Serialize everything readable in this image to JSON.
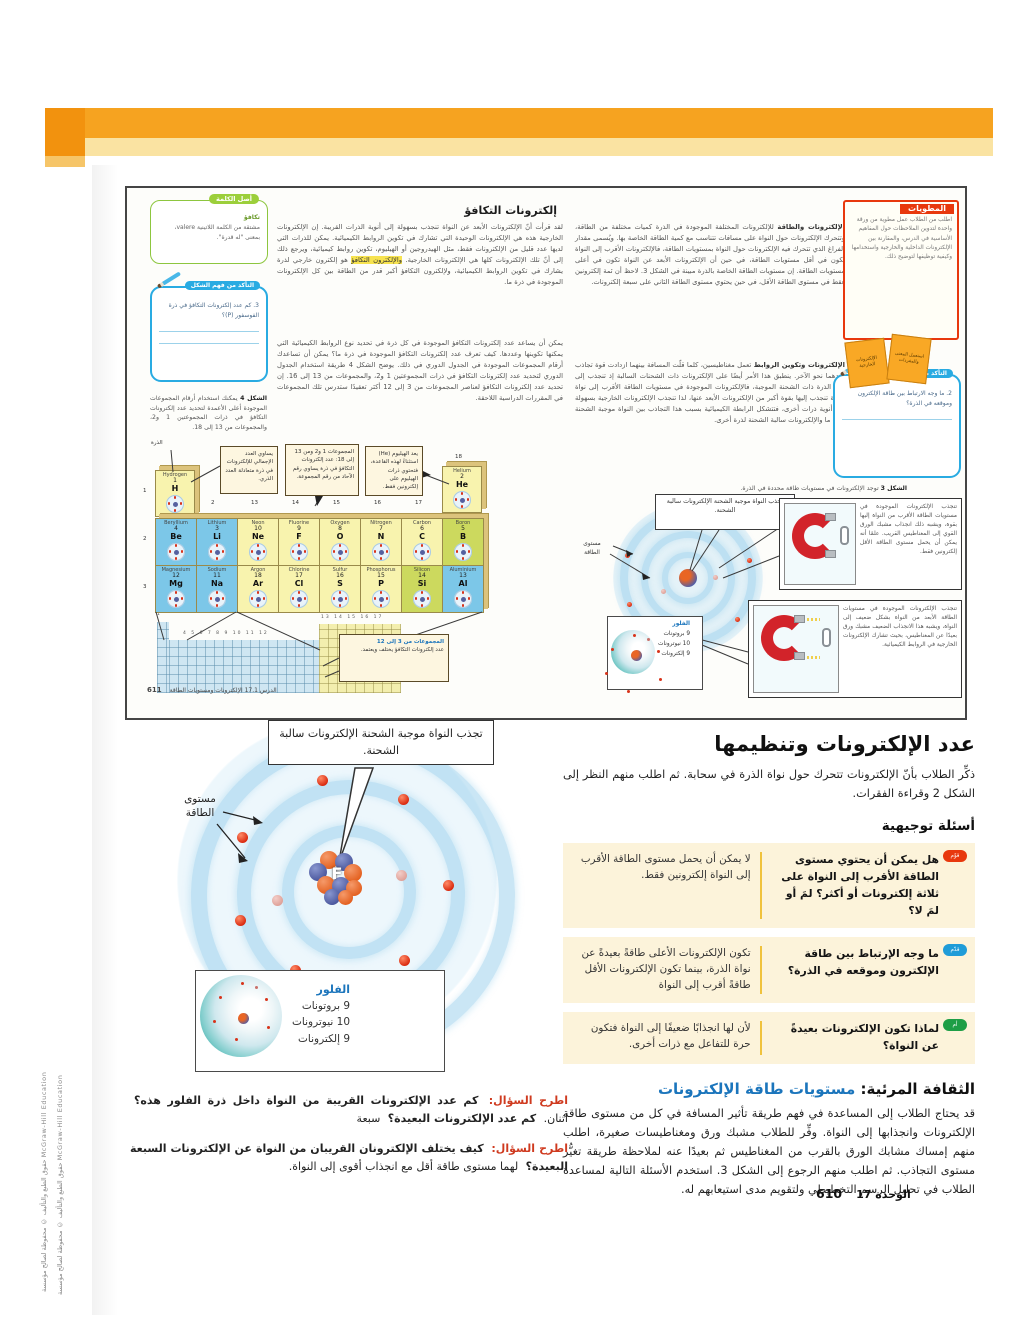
{
  "colors": {
    "accent_orange": "#f6a320",
    "band_pale": "#fae3a2",
    "badge_red": "#e8380d",
    "badge_blue": "#1f9cd8",
    "badge_green": "#1e9e46",
    "heading_blue": "#1b75bc",
    "box_cream": "#fcf3da"
  },
  "page": {
    "copyright": "حقوق الطبع والتأليف © محفوظة لصالح مؤسسة McGraw-Hill Education",
    "photo_credit": "McGraw-Hill Education",
    "footer_page": "610",
    "footer_unit": "الوحدة 17"
  },
  "mini": {
    "left": {
      "heading": "إلكترونات التكافؤ",
      "para1a": "لقد قرأت أنّ الإلكترونات الأبعد عن النواة تنجذب بسهولة إلى أنوية الذرات القريبة. إن الإلكترونات الخارجية هذه هي الإلكترونات الوحيدة التي تشارك في تكوين الروابط الكيميائية. يمكن للذرات التي لديها عدد قليل من الإلكترونات فقط، مثل الهيدروجين أو الهيليوم، تكوين روابط كيميائية، ويرجع ذلك إلى أنّ تلك الإلكترونات كلها هي الإلكترونات الخارجية.",
      "para1_highlight": "والإلكترون التكافؤ",
      "para1b": "هو إلكترون خارجي لذرة يشارك في تكوين الروابط الكيميائية، ولإلكترون التكافؤ أكبر قدر من الطاقة بين كل الإلكترونات الموجودة في ذرة ما.",
      "para2": "يمكن أن يساعد عدد إلكترونات التكافؤ الموجودة في كل ذرة في تحديد نوع الروابط الكيميائية التي يمكنها تكوينها وعددها. كيف تعرف عدد إلكترونات التكافؤ الموجودة في ذرة ما؟ يمكن أن تساعدك أرقام المجموعات الموجودة في الجدول الدوري في ذلك. يوضح الشكل 4 طريقة استخدام الجدول الدوري لتحديد عدد إلكترونات التكافؤ في ذرات المجموعتين 1 و2، والمجموعات من 13 إلى 16. إن تحديد عدد إلكترونات التكافؤ لعناصر المجموعات من 3 إلى 12 أكثر تعقيدًا ستدرس تلك المجموعات في المقررات الدراسية اللاحقة.",
      "word_origin_title": "أصل الكلمة",
      "word_origin_term": "تكافؤ",
      "word_origin_body": "مشتقة من الكلمة اللاتينية valere، بمعنى \"له قدرة\".",
      "figcheck_title": "التأكد من فهم الشكل",
      "figcheck_item": "3. كم عدد إلكترونات التكافؤ في ذرة الفوسفور (P)؟",
      "fig4_label": "الشكل 4",
      "fig4_caption": "يمكنك استخدام أرقام المجموعات الموجودة أعلى الأعمدة لتحديد عدد إلكترونات التكافؤ في ذرات المجموعتين 1 و2، والمجموعات من 13 إلى 18.",
      "callout_atomic": "يساوي العدد الإجمالي للإلكترونات في ذرة متعادلة العدد الذري.",
      "callout_groups": "المجموعات 1 و2 ومن 13 إلى 18: عدد إلكترونات التكافؤ في ذرة يساوي رقم الآحاد من رقم المجموعة.",
      "callout_helium": "يعد الهيليوم (He) استثناءً لهذه القاعدة، فتحتوي ذرات الهيليوم على إلكترونين فقط.",
      "callout_dblock_title": "المجموعات من 3 إلى 12",
      "callout_dblock_body": "عدد إلكترونات التكافؤ يختلف ويعتمد.",
      "atom_pointer_label": "الذرة",
      "row_labels": [
        "1",
        "2",
        "3"
      ],
      "group_labels": [
        "2",
        "13",
        "14",
        "15",
        "16",
        "17"
      ],
      "group_label_18": "18",
      "grid_numbers_d": "4 5 6 7 8 9 10 11 12",
      "grid_numbers_p": "13 14 15 16 17",
      "grid_number_18": "18",
      "grid_number_1": "1",
      "element_h": {
        "name": "Hydrogen",
        "number": "1",
        "symbol": "H",
        "cat": "nonmetal"
      },
      "element_he": {
        "name": "Helium",
        "number": "2",
        "symbol": "He",
        "cat": "nonmetal"
      },
      "elements_s": [
        {
          "name": "Lithium",
          "number": "3",
          "symbol": "Li",
          "cat": "metal"
        },
        {
          "name": "Beryllium",
          "number": "4",
          "symbol": "Be",
          "cat": "metal"
        },
        {
          "name": "Sodium",
          "number": "11",
          "symbol": "Na",
          "cat": "metal"
        },
        {
          "name": "Magnesium",
          "number": "12",
          "symbol": "Mg",
          "cat": "metal"
        }
      ],
      "elements_p": [
        {
          "name": "Boron",
          "number": "5",
          "symbol": "B",
          "cat": "metalloid"
        },
        {
          "name": "Carbon",
          "number": "6",
          "symbol": "C",
          "cat": "nonmetal"
        },
        {
          "name": "Nitrogen",
          "number": "7",
          "symbol": "N",
          "cat": "nonmetal"
        },
        {
          "name": "Oxygen",
          "number": "8",
          "symbol": "O",
          "cat": "nonmetal"
        },
        {
          "name": "Fluorine",
          "number": "9",
          "symbol": "F",
          "cat": "nonmetal"
        },
        {
          "name": "Neon",
          "number": "10",
          "symbol": "Ne",
          "cat": "nonmetal"
        },
        {
          "name": "Aluminium",
          "number": "13",
          "symbol": "Al",
          "cat": "metal"
        },
        {
          "name": "Silicon",
          "number": "14",
          "symbol": "Si",
          "cat": "metalloid"
        },
        {
          "name": "Phosphorus",
          "number": "15",
          "symbol": "P",
          "cat": "nonmetal"
        },
        {
          "name": "Sulfur",
          "number": "16",
          "symbol": "S",
          "cat": "nonmetal"
        },
        {
          "name": "Chlorine",
          "number": "17",
          "symbol": "Cl",
          "cat": "nonmetal"
        },
        {
          "name": "Argon",
          "number": "18",
          "symbol": "Ar",
          "cat": "nonmetal"
        }
      ],
      "footer_page": "611",
      "footer_lesson": "الدرس 17.1 الإلكترونات ومستويات الطاقة"
    },
    "right": {
      "para1_lead": "الإلكترونات والطاقة",
      "para1": "للإلكترونات المختلفة الموجودة في الذرة كميات مختلفة من الطاقة، وتتحرك الإلكترونات حول النواة على مسافات تتناسب مع كمية الطاقة الخاصة بها. ويُسمى مقدار الفراغ الذي تتحرك فيه الإلكترونات حول النواة بمستويات الطاقة، فالإلكترونات الأقرب إلى النواة تكون في أقل مستويات الطاقة، في حين أن الإلكترونات الأبعد عن النواة تكون في أعلى مستويات الطاقة. إن مستويات الطاقة الخاصة بالذرة مبينة في الشكل 3. لاحظ أن ثمة إلكترونين فقط في مستوى الطاقة الأقل، في حين يحتوي مستوى الطاقة الثاني على سبعة إلكترونات.",
      "para2_lead": "الإلكترونات وتكوين الروابط",
      "para2": "تعمل مغناطيسين، كلما قلّت المسافة بينهما ازدادت قوة تجاذب أحدهما نحو الآخر. ينطبق هذا الأمر أيضًا على الإلكترونات ذات الشحنات السالبة إذ تنجذب إلى نواة الذرة ذات الشحنة الموجبة، فالإلكترونات الموجودة في مستويات الطاقة الأقرب إلى نواة الذرة تنجذب إليها بقوة أكبر من الإلكترونات الأبعد عنها، لذا تنجذب الإلكترونات الخارجية بسهولة إلى أنوية ذرات أخرى، فتتشكل الرابطة الكيميائية بسبب هذا التجاذب بين النواة موجبة الشحنة لذرة ما والإلكترونات سالبة الشحنة لذرة أخرى.",
      "foldables_title": "المطويات",
      "foldables_body": "اطلب من الطلاب عمل مطوية من ورقة واحدة لتدوين الملاحظات حول المفاهيم الأساسية في الدرس، والمقارنة بين الإلكترونات الداخلية والخارجية واستخدامها وكيفية توظيفها لتوضيح ذلك.",
      "foldable_card1": "الإلكترونات الخارجية",
      "foldable_card2": "استعمل المعنى والمفردات",
      "prior_title": "التأكد من المعرفة الأساسية",
      "prior_item": "2. ما وجه الارتباط بين طاقة الإلكترون وموقعه في الذرة؟",
      "fig3_label": "الشكل 3",
      "fig3_caption": "توجد الإلكترونات في مستويات طاقة محددة في الذرة.",
      "nucleus_callout": "تجذب النواة موجبة الشحنة الإلكترونات سالبة الشحنة.",
      "energy_label": "مستوى الطاقة",
      "magnet1": "تنجذب الإلكترونات الموجودة في مستويات الطاقة الأقرب من النواة إليها بقوة، ويشبه ذلك انجذاب مشبك الورق القوي إلى المغناطيس القريب. علمًا أنه يمكن أن يحمل مستوى الطاقة الأقل إلكترونين فقط.",
      "magnet2": "تنجذب الإلكترونات الموجودة في مستويات الطاقة الأبعد من النواة بشكل ضعيف إلى النواة، ويشبه هذا الانجذاب الضعيف مشبك ورق بعيدًا عن المغناطيس، بحيث تشارك الإلكترونات الخارجية في الروابط الكيميائية.",
      "fluorine_title": "الفلور",
      "fluorine_protons": "9 بروتونات",
      "fluorine_neutrons": "10 نيوترونات",
      "fluorine_electrons": "9 إلكترونات",
      "footer_page": "610",
      "footer_unit": "الوحدة 17"
    }
  },
  "figure": {
    "nucleus_callout": "تجذب النواة موجبة الشحنة الإلكترونات سالبة الشحنة.",
    "energy_label": "مستوى الطاقة",
    "nucleus_symbol": "F",
    "fluorine_title": "الفلور",
    "fluorine_protons": "9 بروتونات",
    "fluorine_neutrons": "10 نيوترونات",
    "fluorine_electrons": "9 إلكترونات"
  },
  "main": {
    "ask_label": "اطرح السؤال:",
    "ask1_q": "كم عدد الإلكترونات القريبة من النواة داخل ذرة الفلور هذه؟",
    "ask1_a": "اثنان.",
    "ask1_q2": "كم عدد الإلكترونات البعيدة؟",
    "ask1_a2": "سبعة",
    "ask2_q": "كيف يختلف الإلكترونان القريبان من النواة عن الإلكترونات السبعة البعيدة؟",
    "ask2_a": "لهما مستوى طاقة أقل مع انجذاب أقوى إلى النواة.",
    "heading": "عدد الإلكترونات وتنظيمها",
    "intro": "ذكِّر الطلاب بأنّ الإلكترونات تتحرك حول نواة الذرة في سحابة. ثم اطلب منهم النظر إلى الشكل 2 وقراءة الفقرات.",
    "guiding_title": "أسئلة توجيهية",
    "questions": [
      {
        "badge": "قوّم",
        "q": "هل يمكن أن يحتوي مستوى الطاقة الأقرب إلى النواة على ثلاثة إلكترونات أو أكثر؟ لمَ أو لمَ لا؟",
        "a": "لا يمكن أن يحمل مستوى الطاقة الأقرب إلى النواة إلكترونين فقط."
      },
      {
        "badge": "قدّم",
        "q": "ما وجه الإرتباط بين طاقة الإلكترون وموقعه في الذرة؟",
        "a": "تكون الإلكترونات الأعلى طاقةً بعيدةً عن نواة الذرة، بينما تكون الإلكترونات الأقل طاقةً أقرب إلى النواة"
      },
      {
        "badge": "أم",
        "q": "لماذا تكون الإلكترونات بعيدةً عن النواة؟",
        "a": "لأن لها انجذابًا ضعيفًا إلى النواة فتكون حرة للتفاعل مع ذرات أخرى."
      }
    ],
    "visual_title_black": "الثقافة المرئية:",
    "visual_title_blue": "مستويات طاقة الإلكترونات",
    "visual_body": "قد يحتاج الطلاب إلى المساعدة في فهم طريقة تأثير المسافة في كل من مستوى طاقة الإلكترونات وانجذابها إلى النواة. وفِّر للطلاب مشبك ورق ومغناطيسات صغيرة، اطلب منهم إمساك مشابك الورق بالقرب من المغناطيس ثم بعيدًا عنه لملاحظة طريقة تغيُّر مستوى التجاذب. ثم اطلب منهم الرجوع إلى الشكل 3. استخدم الأسئلة التالية لمساعدة الطلاب في تحليل الرسم التخطيطي ولتقويم مدى استيعابهم له."
  }
}
